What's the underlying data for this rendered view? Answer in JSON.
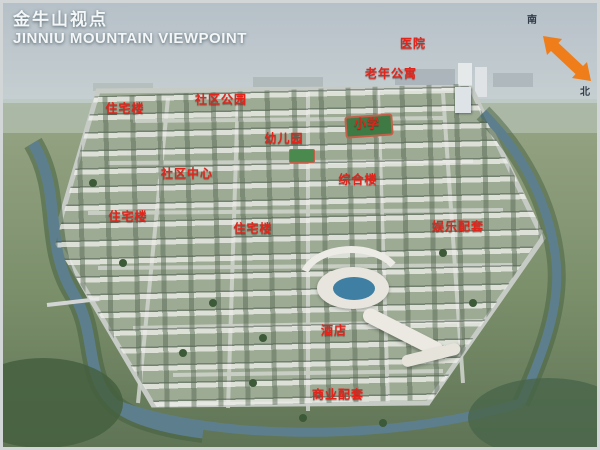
{
  "header": {
    "title_zh": "金牛山视点",
    "title_en": "JINNIU MOUNTAIN VIEWPOINT"
  },
  "compass": {
    "south": "南",
    "north": "北"
  },
  "map_labels": [
    {
      "id": "hospital",
      "text": "医院",
      "x": 410,
      "y": 40
    },
    {
      "id": "senior-apartments",
      "text": "老年公寓",
      "x": 388,
      "y": 70
    },
    {
      "id": "residential-1",
      "text": "住宅楼",
      "x": 122,
      "y": 105
    },
    {
      "id": "community-park",
      "text": "社区公园",
      "x": 218,
      "y": 96
    },
    {
      "id": "kindergarten",
      "text": "幼儿园",
      "x": 281,
      "y": 135
    },
    {
      "id": "primary-school",
      "text": "小学",
      "x": 364,
      "y": 120
    },
    {
      "id": "community-center",
      "text": "社区中心",
      "x": 184,
      "y": 170
    },
    {
      "id": "complex-building",
      "text": "综合楼",
      "x": 355,
      "y": 176
    },
    {
      "id": "residential-2",
      "text": "住宅楼",
      "x": 125,
      "y": 213
    },
    {
      "id": "residential-3",
      "text": "住宅楼",
      "x": 250,
      "y": 225
    },
    {
      "id": "entertainment",
      "text": "娱乐配套",
      "x": 455,
      "y": 223
    },
    {
      "id": "hotel",
      "text": "酒店",
      "x": 331,
      "y": 327
    },
    {
      "id": "commercial",
      "text": "商业配套",
      "x": 335,
      "y": 391
    }
  ],
  "colors": {
    "label_red": "#e3241b",
    "arrow_orange": "#ef7d1a",
    "water_blue": "#5d7f8d",
    "title_white": "#f4f7f8"
  }
}
